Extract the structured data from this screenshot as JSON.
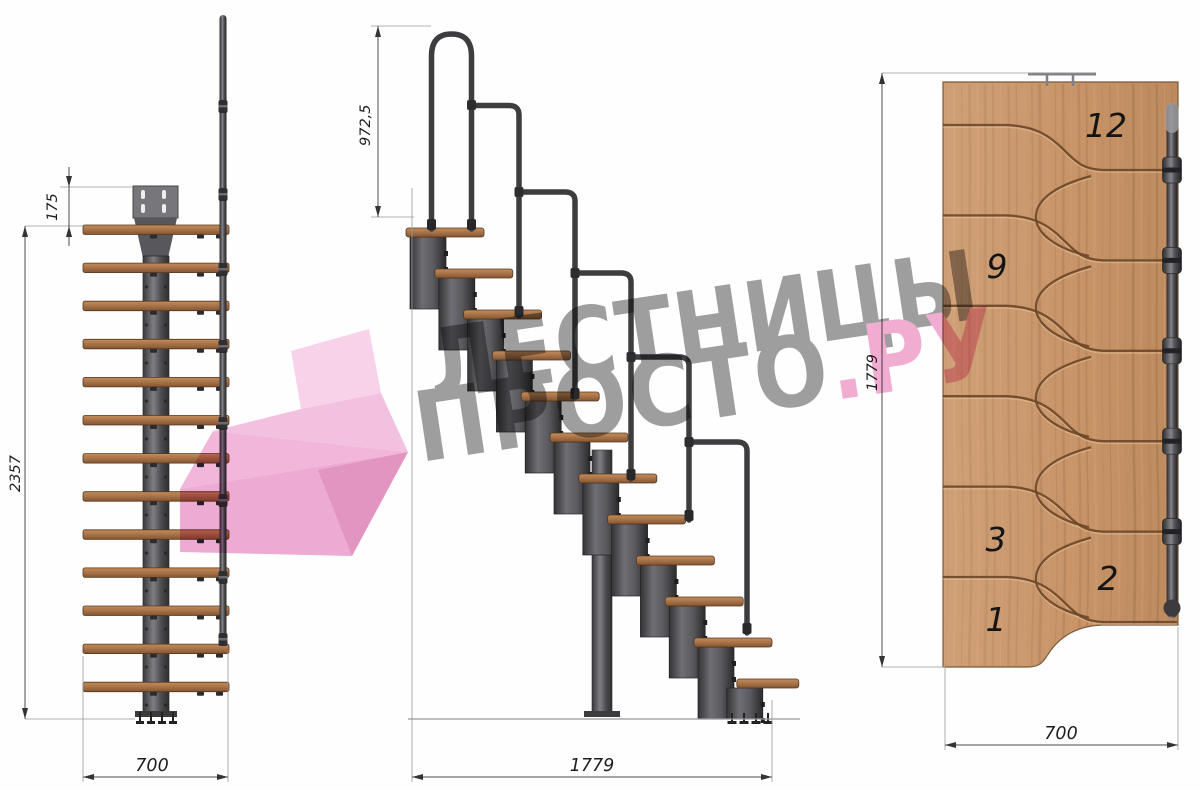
{
  "watermark": {
    "line1": "ЛЕСТНИЦЫ",
    "line2": "ПРОСТО",
    "line2_suffix": ".РУ",
    "gray": "#8e8e8e",
    "pink": "#f0a0ca"
  },
  "views": {
    "front": {
      "title": "front-view-of-modular-staircase",
      "dims": {
        "plate_offset": "175",
        "total_height": "2357",
        "width": "700"
      }
    },
    "side": {
      "title": "side-view-of-modular-staircase",
      "dims": {
        "handrail_height": "972,5",
        "length": "1779"
      }
    },
    "plan": {
      "title": "top-plan-view-of-modular-staircase",
      "dims": {
        "height": "1779",
        "width": "700"
      },
      "steps_total": 12,
      "step_labels": [
        "12",
        "9",
        "3",
        "2",
        "1"
      ]
    }
  },
  "colors": {
    "wood": "#b8804f",
    "plan_wood": "#c89468",
    "groove": "#6b4729",
    "metal": "#3d3d40",
    "dim_line": "#4a4a4a",
    "watermark_gray": "#8e8e8e",
    "watermark_pink": "#f0a0ca"
  }
}
